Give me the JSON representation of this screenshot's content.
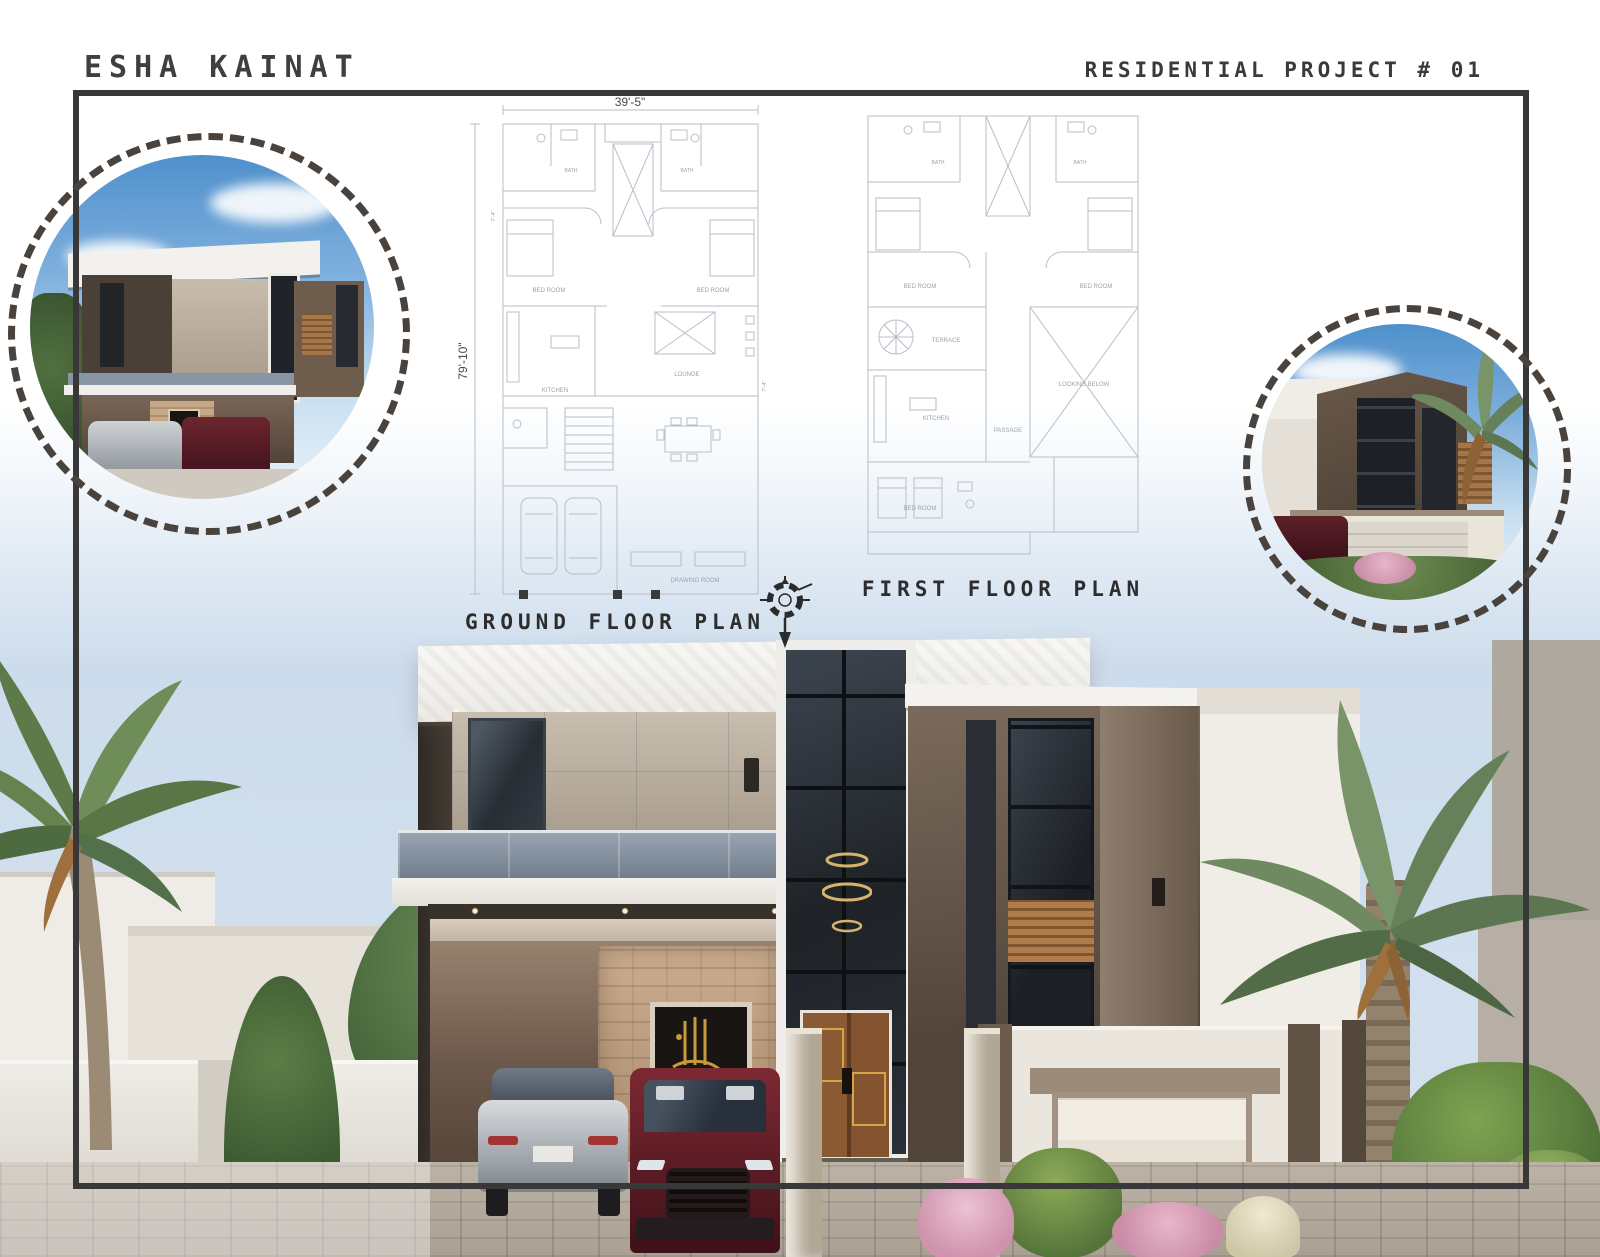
{
  "header": {
    "author": "ESHA KAINAT",
    "project": "RESIDENTIAL PROJECT # 01"
  },
  "plans": {
    "ground": {
      "label": "GROUND FLOOR PLAN",
      "dim_width": "39'-5\"",
      "dim_height": "79'-10\"",
      "dim_side_left": "7'-4\"",
      "dim_side_right": "7'-4\"",
      "rooms": [
        "BED ROOM",
        "BED ROOM",
        "BATH",
        "BATH",
        "KITCHEN",
        "LOUNGE",
        "DRAWING ROOM"
      ]
    },
    "first": {
      "label": "FIRST FLOOR PLAN",
      "rooms": [
        "BED ROOM",
        "BED ROOM",
        "BATH",
        "BATH",
        "TERRACE",
        "KITCHEN",
        "PASSAGE",
        "LOOKING BELOW",
        "BED ROOM"
      ]
    }
  },
  "colors": {
    "frame": "#383838",
    "dashed_ring": "#4a423c",
    "title_text": "#3f3f3f",
    "plan_line": "#b7bec7",
    "plan_text": "#9aa3ad",
    "wood_accent": "#a5764a",
    "sky": "#cddcec"
  }
}
